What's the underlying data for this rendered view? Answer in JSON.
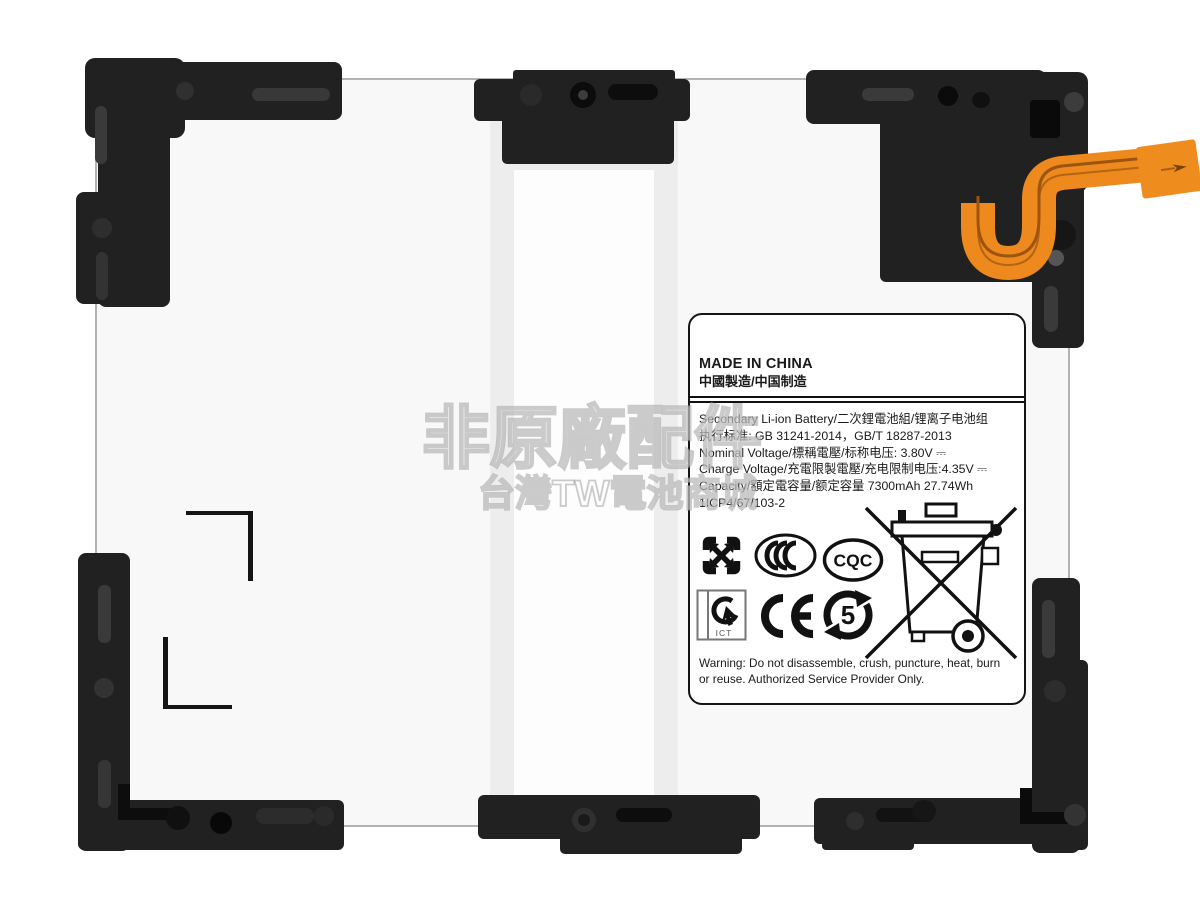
{
  "watermark": {
    "line1": "非原廠配件",
    "line2": "台灣TW電池商城"
  },
  "label": {
    "made_in": "MADE IN CHINA",
    "made_in_cn": "中國製造/中国制造",
    "specs": [
      "Secondary Li-ion Battery/二次鋰電池組/锂离子电池组",
      "执行标准: GB 31241-2014，GB/T 18287-2013",
      "Nominal Voltage/標稱電壓/标称电压: 3.80V ⎓",
      "Charge Voltage/充電限製電壓/充电限制电压:4.35V ⎓",
      "Capacity/額定電容量/额定容量  7300mAh 27.74Wh",
      "1ICP4/67/103-2"
    ],
    "warning": "Warning: Do not disassemble, crush, puncture, heat, burn or reuse. Authorized Service Provider Only.",
    "marks": {
      "ccc": "CCC",
      "cqc": "CQC",
      "ict": "ICT",
      "ce": "CE",
      "rohs_year": "5"
    }
  },
  "icons": [
    "taiwan-recycling-icon",
    "ccc-certification-icon",
    "cqc-certification-icon",
    "ict-recycling-icon",
    "ce-mark-icon",
    "china-rohs-5-icon",
    "weee-crossed-bin-icon"
  ],
  "colors": {
    "flex_cable": "#ee8a1d",
    "bracket_plastic": "#212121",
    "battery_edge": "#b3b3b3",
    "label_border": "#151515"
  }
}
